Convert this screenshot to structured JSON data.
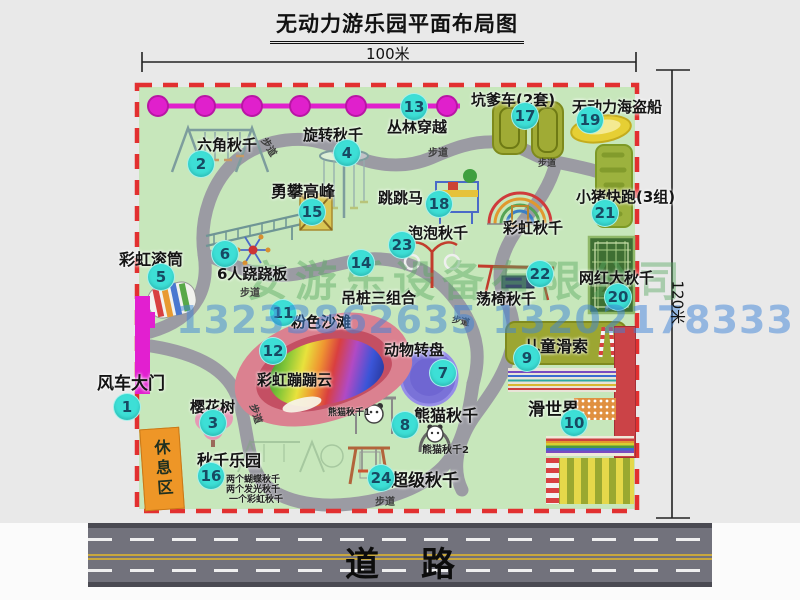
{
  "title": "无动力游乐园平面布局图",
  "dimensions": {
    "width_label": "100米",
    "height_label": "120米"
  },
  "road": {
    "label": "道路"
  },
  "watermark": {
    "company": "安游乐设备有限公司",
    "phone": "13233862635 13202178333"
  },
  "misc": {
    "path_label": "步道",
    "rainbow_swing_label": "彩虹秋千",
    "rest_area_label": "休息区"
  },
  "attractions": [
    {
      "num": "1",
      "label": "风车大门"
    },
    {
      "num": "2",
      "label": "六角秋千"
    },
    {
      "num": "3",
      "label": "樱花树"
    },
    {
      "num": "4",
      "label": "旋转秋千"
    },
    {
      "num": "5",
      "label": "彩虹滚筒"
    },
    {
      "num": "6",
      "label": "6人跷跷板"
    },
    {
      "num": "7",
      "label": "动物转盘"
    },
    {
      "num": "8",
      "label": "熊猫秋千",
      "sub1": "熊猫秋千1",
      "sub2": "熊猫秋千2"
    },
    {
      "num": "9",
      "label": "儿童滑索"
    },
    {
      "num": "10",
      "label": "滑世界"
    },
    {
      "num": "11",
      "label": "粉色沙滩"
    },
    {
      "num": "12",
      "label": "彩虹蹦蹦云"
    },
    {
      "num": "13",
      "label": "丛林穿越"
    },
    {
      "num": "14",
      "label": "吊桩三组合"
    },
    {
      "num": "15",
      "label": "勇攀高峰"
    },
    {
      "num": "16",
      "label": "秋千乐园",
      "notes": [
        "两个蝴蝶秋千",
        "两个发光秋千",
        "一个彩虹秋千"
      ]
    },
    {
      "num": "17",
      "label": "坑爹车(2套)"
    },
    {
      "num": "18",
      "label": "跳跳马"
    },
    {
      "num": "19",
      "label": "无动力海盗船"
    },
    {
      "num": "20",
      "label": "网红大秋千"
    },
    {
      "num": "21",
      "label": "小猪快跑(3组)"
    },
    {
      "num": "22",
      "label": "荡椅秋千"
    },
    {
      "num": "23",
      "label": "泡泡秋千"
    },
    {
      "num": "24",
      "label": "超级秋千"
    }
  ]
}
